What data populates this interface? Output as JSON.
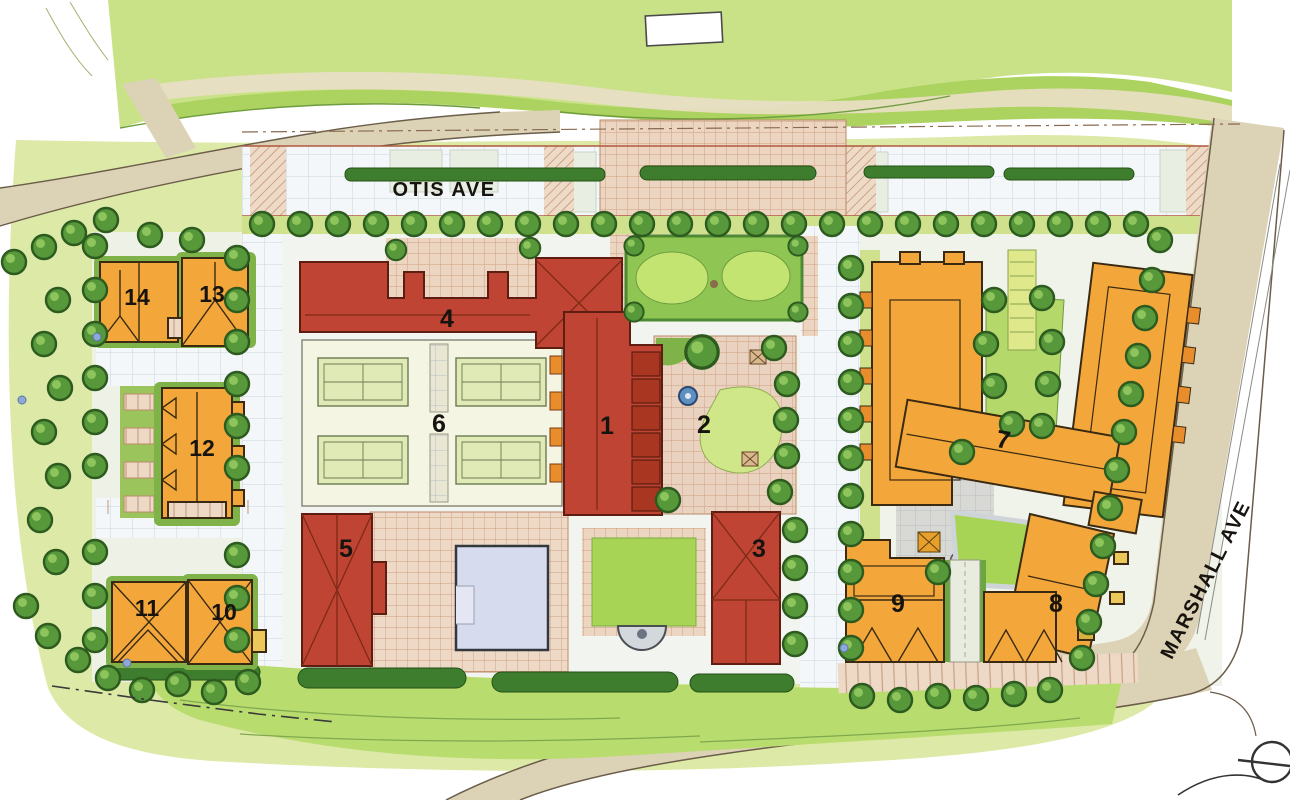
{
  "plan_labels": {
    "street_otis": "OTIS AVE",
    "street_marshall": "MARSHALL AVE"
  },
  "buildings": [
    {
      "num": "1"
    },
    {
      "num": "2"
    },
    {
      "num": "3"
    },
    {
      "num": "4"
    },
    {
      "num": "5"
    },
    {
      "num": "6"
    },
    {
      "num": "7"
    },
    {
      "num": "8"
    },
    {
      "num": "9"
    },
    {
      "num": "10"
    },
    {
      "num": "11"
    },
    {
      "num": "12"
    },
    {
      "num": "13"
    },
    {
      "num": "14"
    }
  ],
  "palette": {
    "red_building": "#bf4434",
    "orange_building": "#f3a73b",
    "lawn_green": "#a8d455",
    "tree_green": "#57983a",
    "road_tan": "#dcd2b6",
    "paving_pink": "#ecd6c2",
    "pool_blue": "#d7dbee"
  }
}
